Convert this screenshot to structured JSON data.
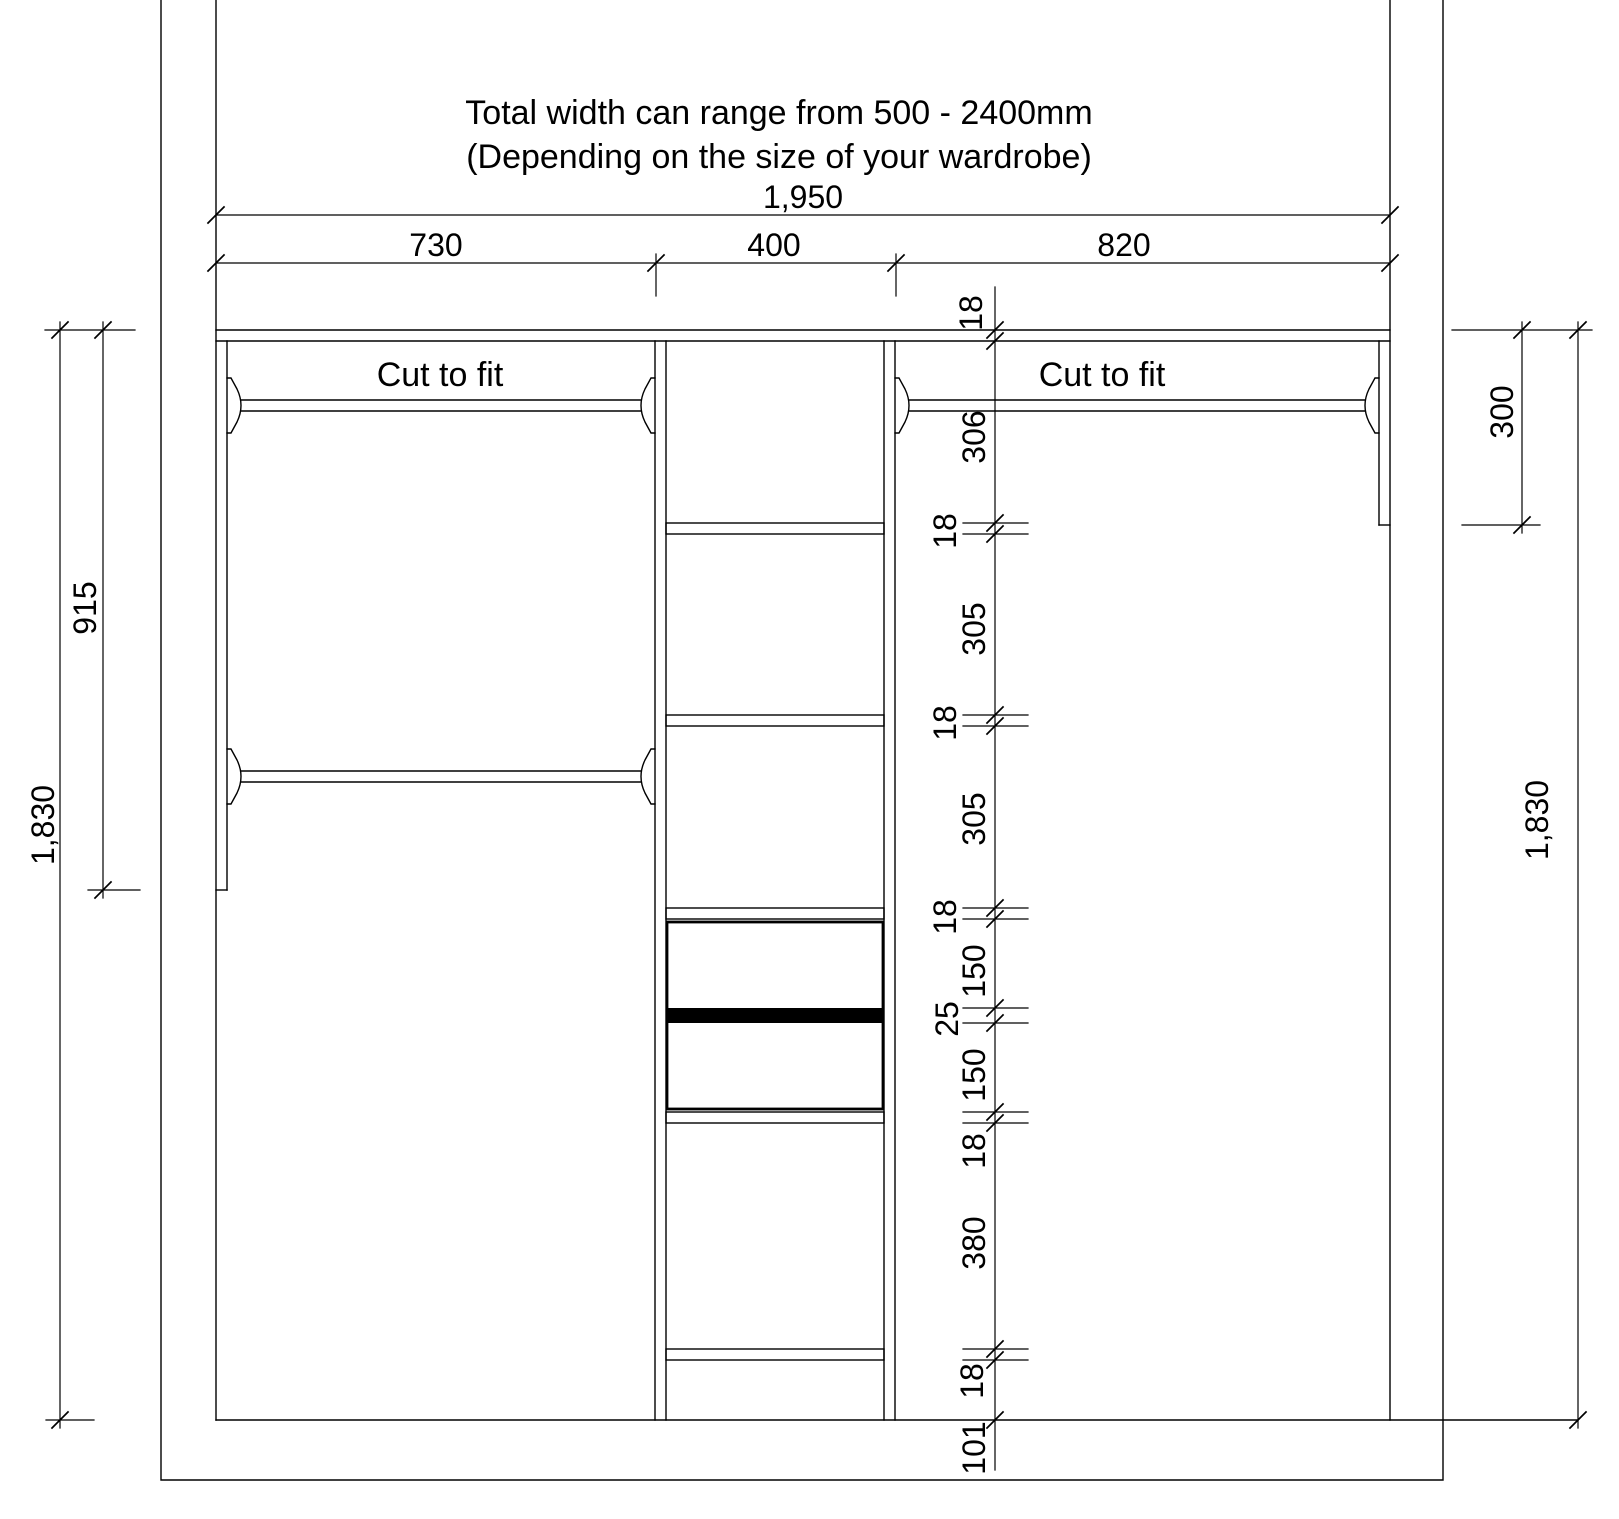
{
  "title": {
    "line1": "Total width can range from 500 - 2400mm",
    "line2": "(Depending on the size of your wardrobe)"
  },
  "rails": {
    "left_label": "Cut to fit",
    "right_label": "Cut to fit"
  },
  "dimensions": {
    "total_width": "1,950",
    "width_left": "730",
    "width_middle": "400",
    "width_right": "820",
    "height_total_left": "1,830",
    "height_total_right": "1,830",
    "left_panel_height": "915",
    "right_panel_height": "300",
    "chain": [
      "18",
      "306",
      "18",
      "305",
      "18",
      "305",
      "18",
      "150",
      "25",
      "150",
      "18",
      "380",
      "18",
      "101"
    ]
  },
  "colors": {
    "line": "#000000",
    "background": "#ffffff",
    "drawer_band": "#000000"
  }
}
